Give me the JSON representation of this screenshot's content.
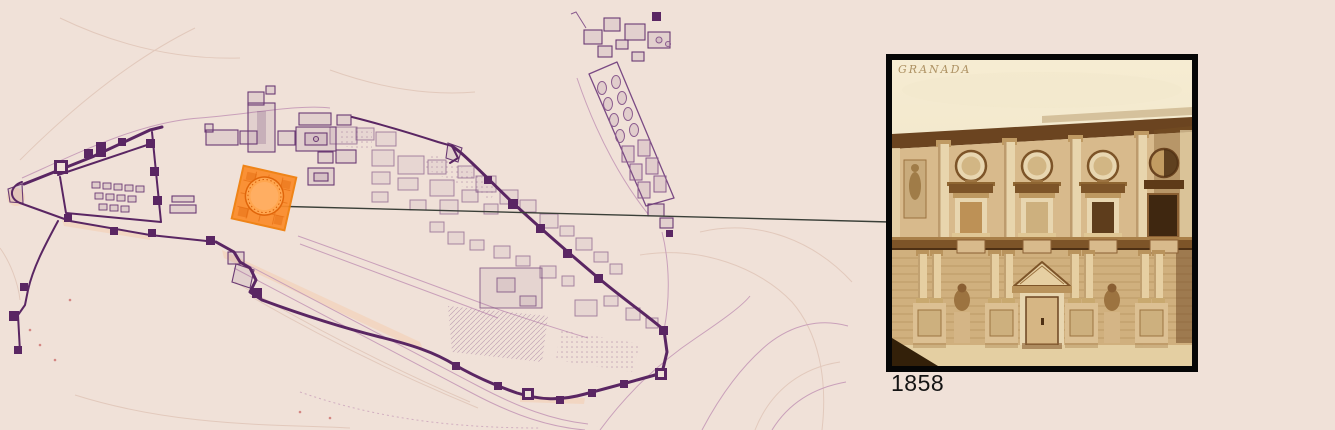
{
  "scene": {
    "background_color": "#f0e1d8"
  },
  "map": {
    "ink_color": "#5a2663",
    "faint_ink_color": "#c9a0ba",
    "highlight": {
      "color": "#fb8c2a",
      "stroke_color": "#ef7d0a"
    }
  },
  "connector": {
    "color": "#3a3f38"
  },
  "photo": {
    "inscription": "GRANADA",
    "caption": "1858",
    "border_color": "#060606",
    "tone": "sepia"
  }
}
